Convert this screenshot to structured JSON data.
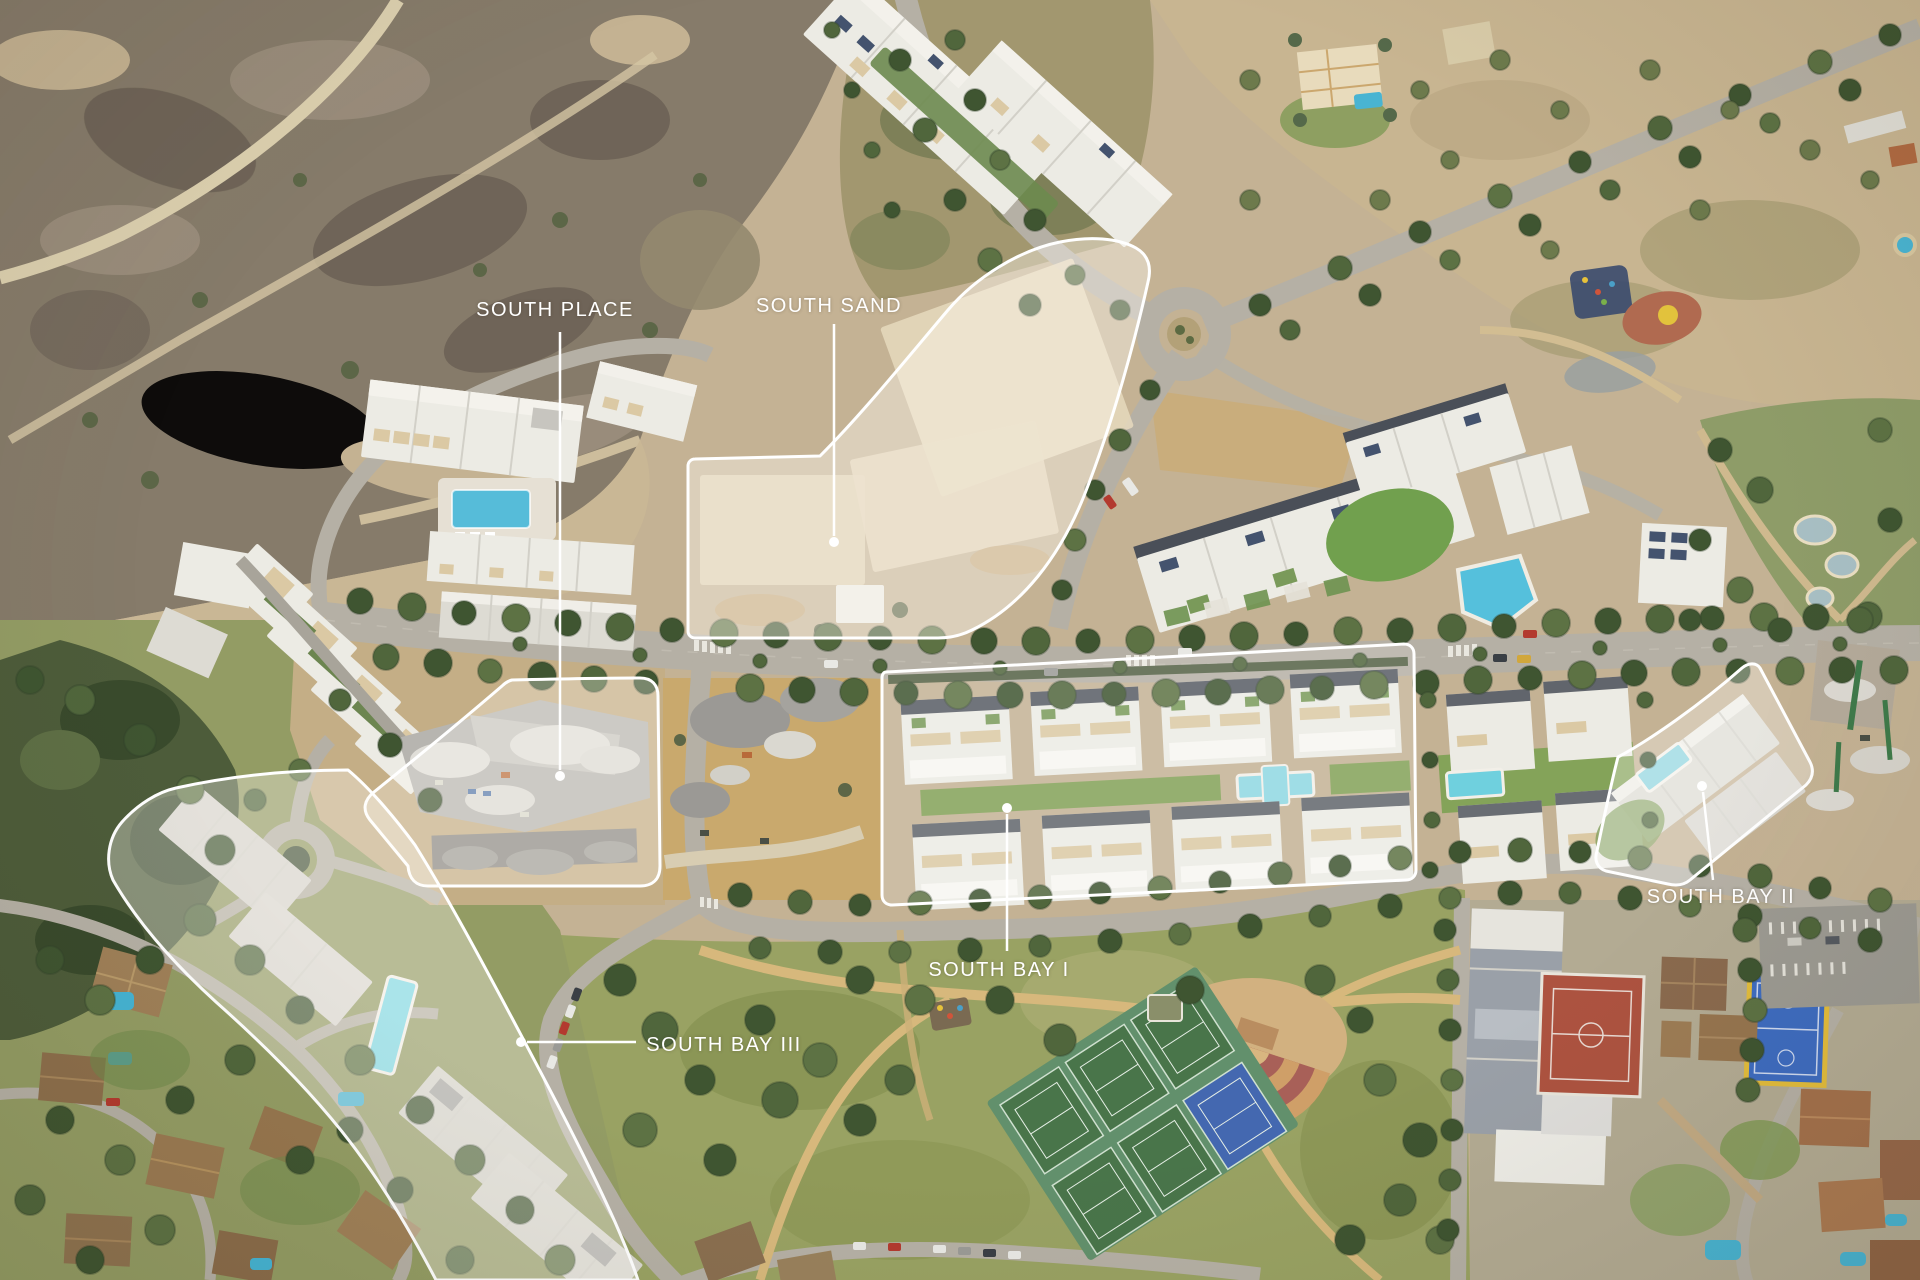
{
  "scene": {
    "type": "aerial-development-masterplan",
    "description": "Aerial drone photograph of a coastal residential development with five labeled parcels"
  },
  "labels": {
    "south_place": "SOUTH PLACE",
    "south_sand": "SOUTH SAND",
    "south_bay_i": "SOUTH BAY I",
    "south_bay_ii": "SOUTH BAY II",
    "south_bay_iii": "SOUTH BAY III"
  },
  "colors": {
    "label_text": "#ffffff",
    "leader_line": "#ffffff",
    "parcel_outline": "#ffffff",
    "terrain_sand": "#c4b294",
    "scrubland": "#867b6a",
    "road": "#b5b0a5",
    "tree": "#3f5531",
    "pool": "#56bcd9",
    "lawn": "#74a050",
    "red_court": "#ad5340",
    "blue_court": "#3e6cc0",
    "amph_tan": "#cf9f68",
    "amph_red": "#a86058"
  }
}
